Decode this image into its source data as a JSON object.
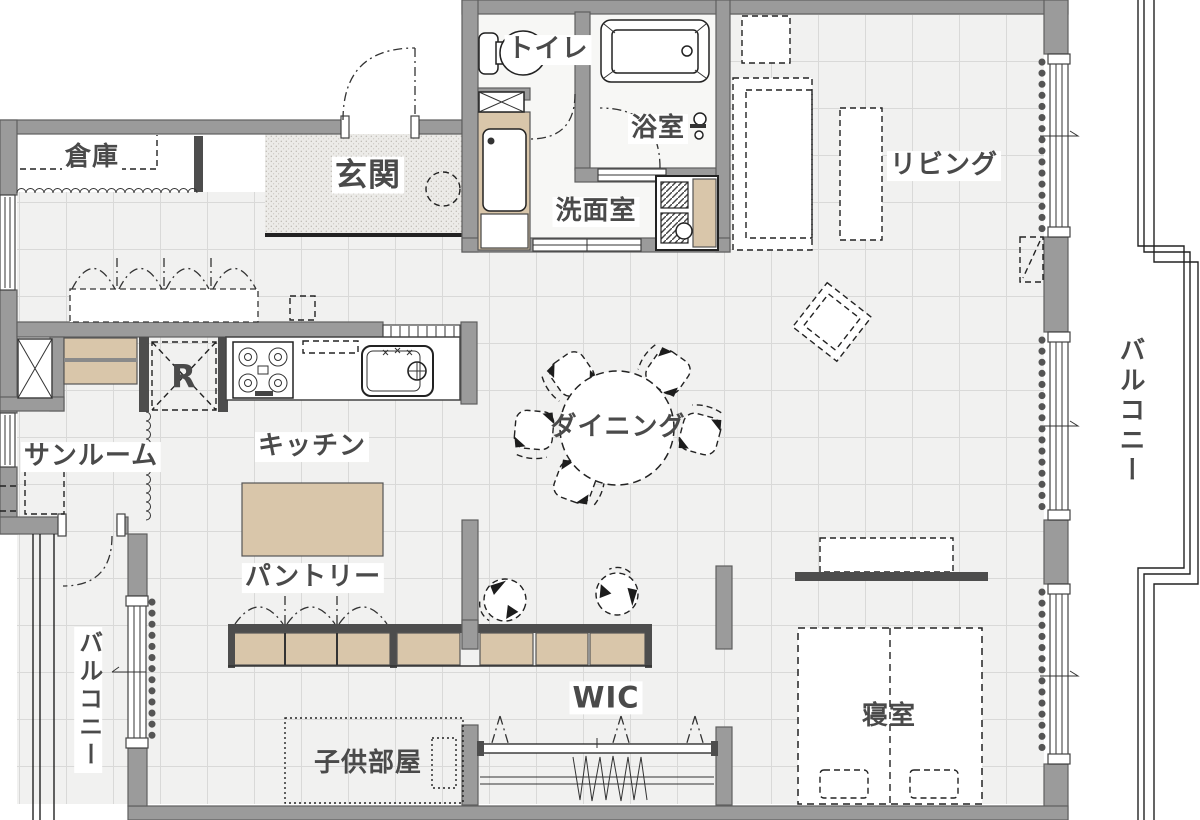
{
  "colors": {
    "wall": "#9b9b9b",
    "wall_edge": "#5f5f5f",
    "wall_dark": "#4d4d4d",
    "beige": "#d9c6aa",
    "floor": "#f1f1f0",
    "grid": "#d9d9d8",
    "label": "#4a4a4a"
  },
  "rooms": {
    "storage": "倉庫",
    "entrance": "玄関",
    "toilet": "トイレ",
    "bath": "浴室",
    "washroom": "洗面室",
    "living": "リビング",
    "balcony_right": "バルコニー",
    "sunroom": "サンルーム",
    "kitchen": "キッチン",
    "fridge": "R",
    "dining": "ダイニング",
    "pantry": "パントリー",
    "balcony_left": "バルコニー",
    "wic": "WIC",
    "kids_room": "子供部屋",
    "bedroom": "寝室"
  }
}
